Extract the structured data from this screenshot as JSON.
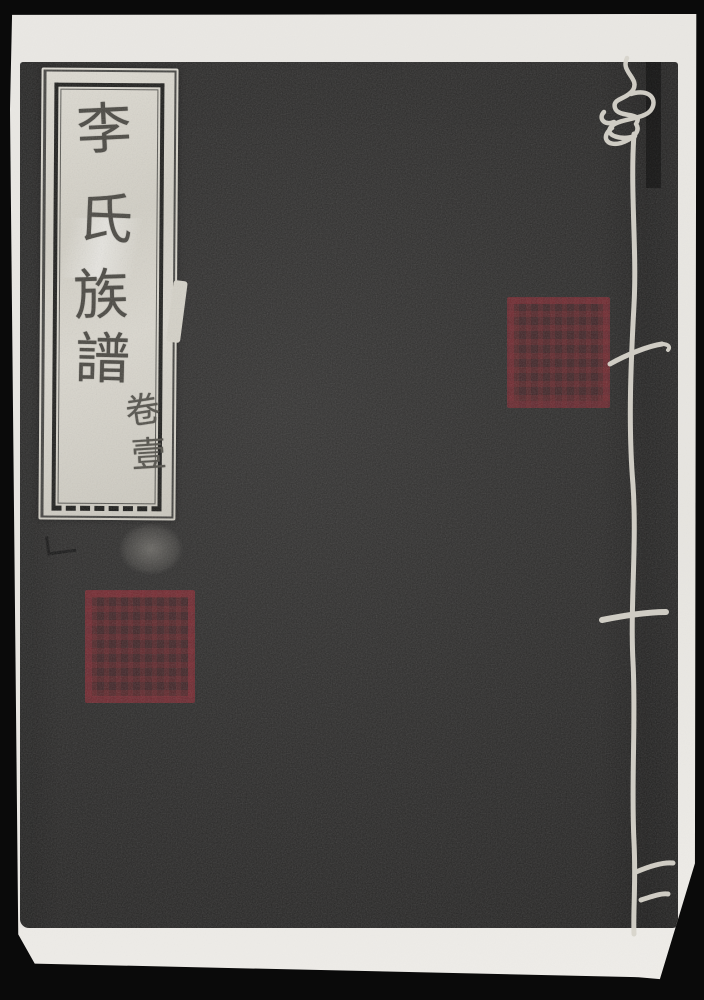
{
  "photo": {
    "kind": "scanned book cover photograph"
  },
  "cover_label": {
    "title_text": "李氏族譜",
    "title_chars": [
      "李",
      "氏",
      "族",
      "譜"
    ],
    "volume_text": "卷壹",
    "volume_chars": [
      "卷",
      "壹"
    ]
  },
  "seals": {
    "top_seal": "square red seal stamp, illegible",
    "bottom_seal": "square red seal stamp, illegible"
  },
  "colors": {
    "background": "#0a0a0a",
    "paper": "#e8e6e1",
    "cover": "#262524",
    "label_paper": "#d7d4ca",
    "ink": "#46443e",
    "seal_red": "#76262e",
    "thread": "#d8d5cc"
  }
}
